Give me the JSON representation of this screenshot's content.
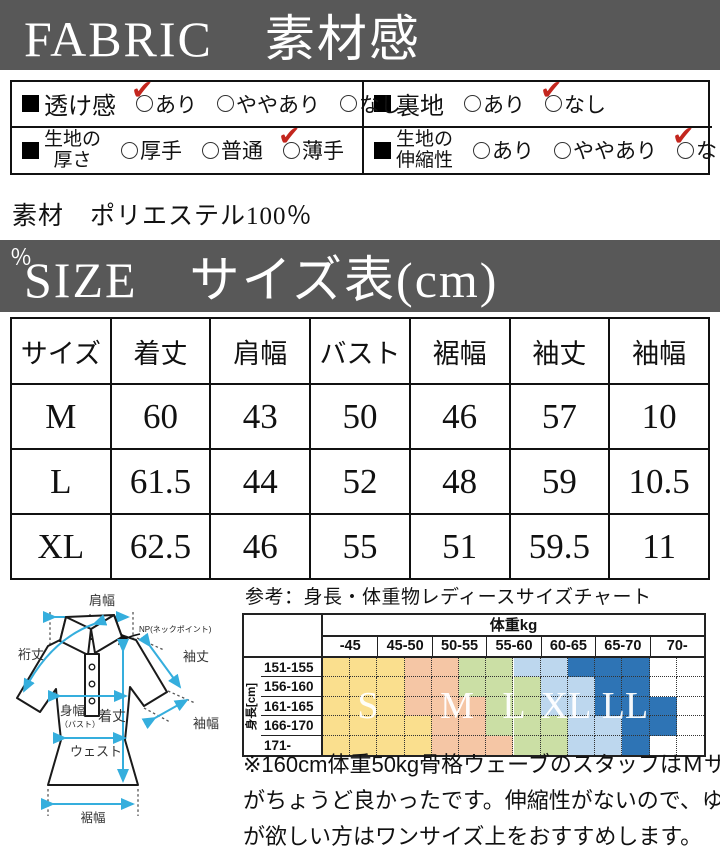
{
  "colors": {
    "banner_bg": "#585858",
    "check_red": "#c3261e",
    "arrow_blue": "#35AEDD",
    "band_colors": [
      "#FADF8E",
      "#F5C6A5",
      "#CBDFA5",
      "#BDD7EE",
      "#2E74B5",
      "#FFFFFF"
    ]
  },
  "fabric_section": {
    "banner": "FABRIC　素材感",
    "check_glyph": "✔",
    "circle_glyph": "○",
    "cells": [
      {
        "marker": "■",
        "label_lines": [
          "透け感"
        ],
        "options": [
          {
            "text": "あり",
            "checked": true
          },
          {
            "text": "ややあり",
            "checked": false
          },
          {
            "text": "なし",
            "checked": false
          }
        ]
      },
      {
        "marker": "■",
        "label_lines": [
          "裏地"
        ],
        "options": [
          {
            "text": "あり",
            "checked": false
          },
          {
            "text": "なし",
            "checked": true
          }
        ]
      },
      {
        "marker": "■",
        "label_lines": [
          "生地の",
          "厚さ"
        ],
        "options": [
          {
            "text": "厚手",
            "checked": false
          },
          {
            "text": "普通",
            "checked": false
          },
          {
            "text": "薄手",
            "checked": true
          }
        ]
      },
      {
        "marker": "■",
        "label_lines": [
          "生地の",
          "伸縮性"
        ],
        "options": [
          {
            "text": "あり",
            "checked": false
          },
          {
            "text": "ややあり",
            "checked": false
          },
          {
            "text": "なし",
            "checked": true
          }
        ]
      }
    ],
    "material_line": "素材　ポリエステル100％"
  },
  "size_section": {
    "stray_percent": "％",
    "banner": "SIZE　サイズ表(cm)",
    "table": {
      "headers": [
        "サイズ",
        "着丈",
        "肩幅",
        "バスト",
        "裾幅",
        "袖丈",
        "袖幅"
      ],
      "rows": [
        [
          "M",
          "60",
          "43",
          "50",
          "46",
          "57",
          "10"
        ],
        [
          "L",
          "61.5",
          "44",
          "52",
          "48",
          "59",
          "10.5"
        ],
        [
          "XL",
          "62.5",
          "46",
          "55",
          "51",
          "59.5",
          "11"
        ]
      ]
    }
  },
  "diagram": {
    "shoulder": "肩幅",
    "yuki": "裄丈",
    "np": "NP(ネックポイント)",
    "sleeve_length": "袖丈",
    "sleeve_width": "袖幅",
    "body_width": "身幅",
    "body_width_sub": "（バスト）",
    "length": "着丈",
    "waist": "ウェスト",
    "hem": "裾幅"
  },
  "reference_chart": {
    "caption": "参考：身長・体重物レディースサイズチャート",
    "weight_header": "体重kg",
    "height_header": "身長[cm]",
    "weight_cols": [
      "-45",
      "45-50",
      "50-55",
      "55-60",
      "60-65",
      "65-70",
      "70-"
    ],
    "rows": [
      {
        "label": "151-155",
        "bounds": [
          3,
          5,
          7,
          9,
          12
        ]
      },
      {
        "label": "156-160",
        "bounds": [
          3,
          5,
          8,
          10,
          12
        ]
      },
      {
        "label": "161-165",
        "bounds": [
          3,
          6,
          8,
          10,
          13
        ]
      },
      {
        "label": "166-170",
        "bounds": [
          4,
          6,
          9,
          11,
          13
        ]
      },
      {
        "label": "171-",
        "bounds": [
          4,
          7,
          9,
          11,
          12
        ]
      }
    ],
    "letters": [
      {
        "t": "S",
        "x": 124
      },
      {
        "t": "M",
        "x": 213
      },
      {
        "t": "L",
        "x": 270
      },
      {
        "t": "XL",
        "x": 322
      },
      {
        "t": "LL",
        "x": 381
      }
    ],
    "letter_top": 72
  },
  "note": {
    "lines": [
      "※160cm体重50kg骨格ウェーブのスタッフはＭサイズ",
      "がちょうど良かったです。伸縮性がないので、ゆとり",
      "が欲しい方はワンサイズ上をおすすめします。"
    ]
  }
}
